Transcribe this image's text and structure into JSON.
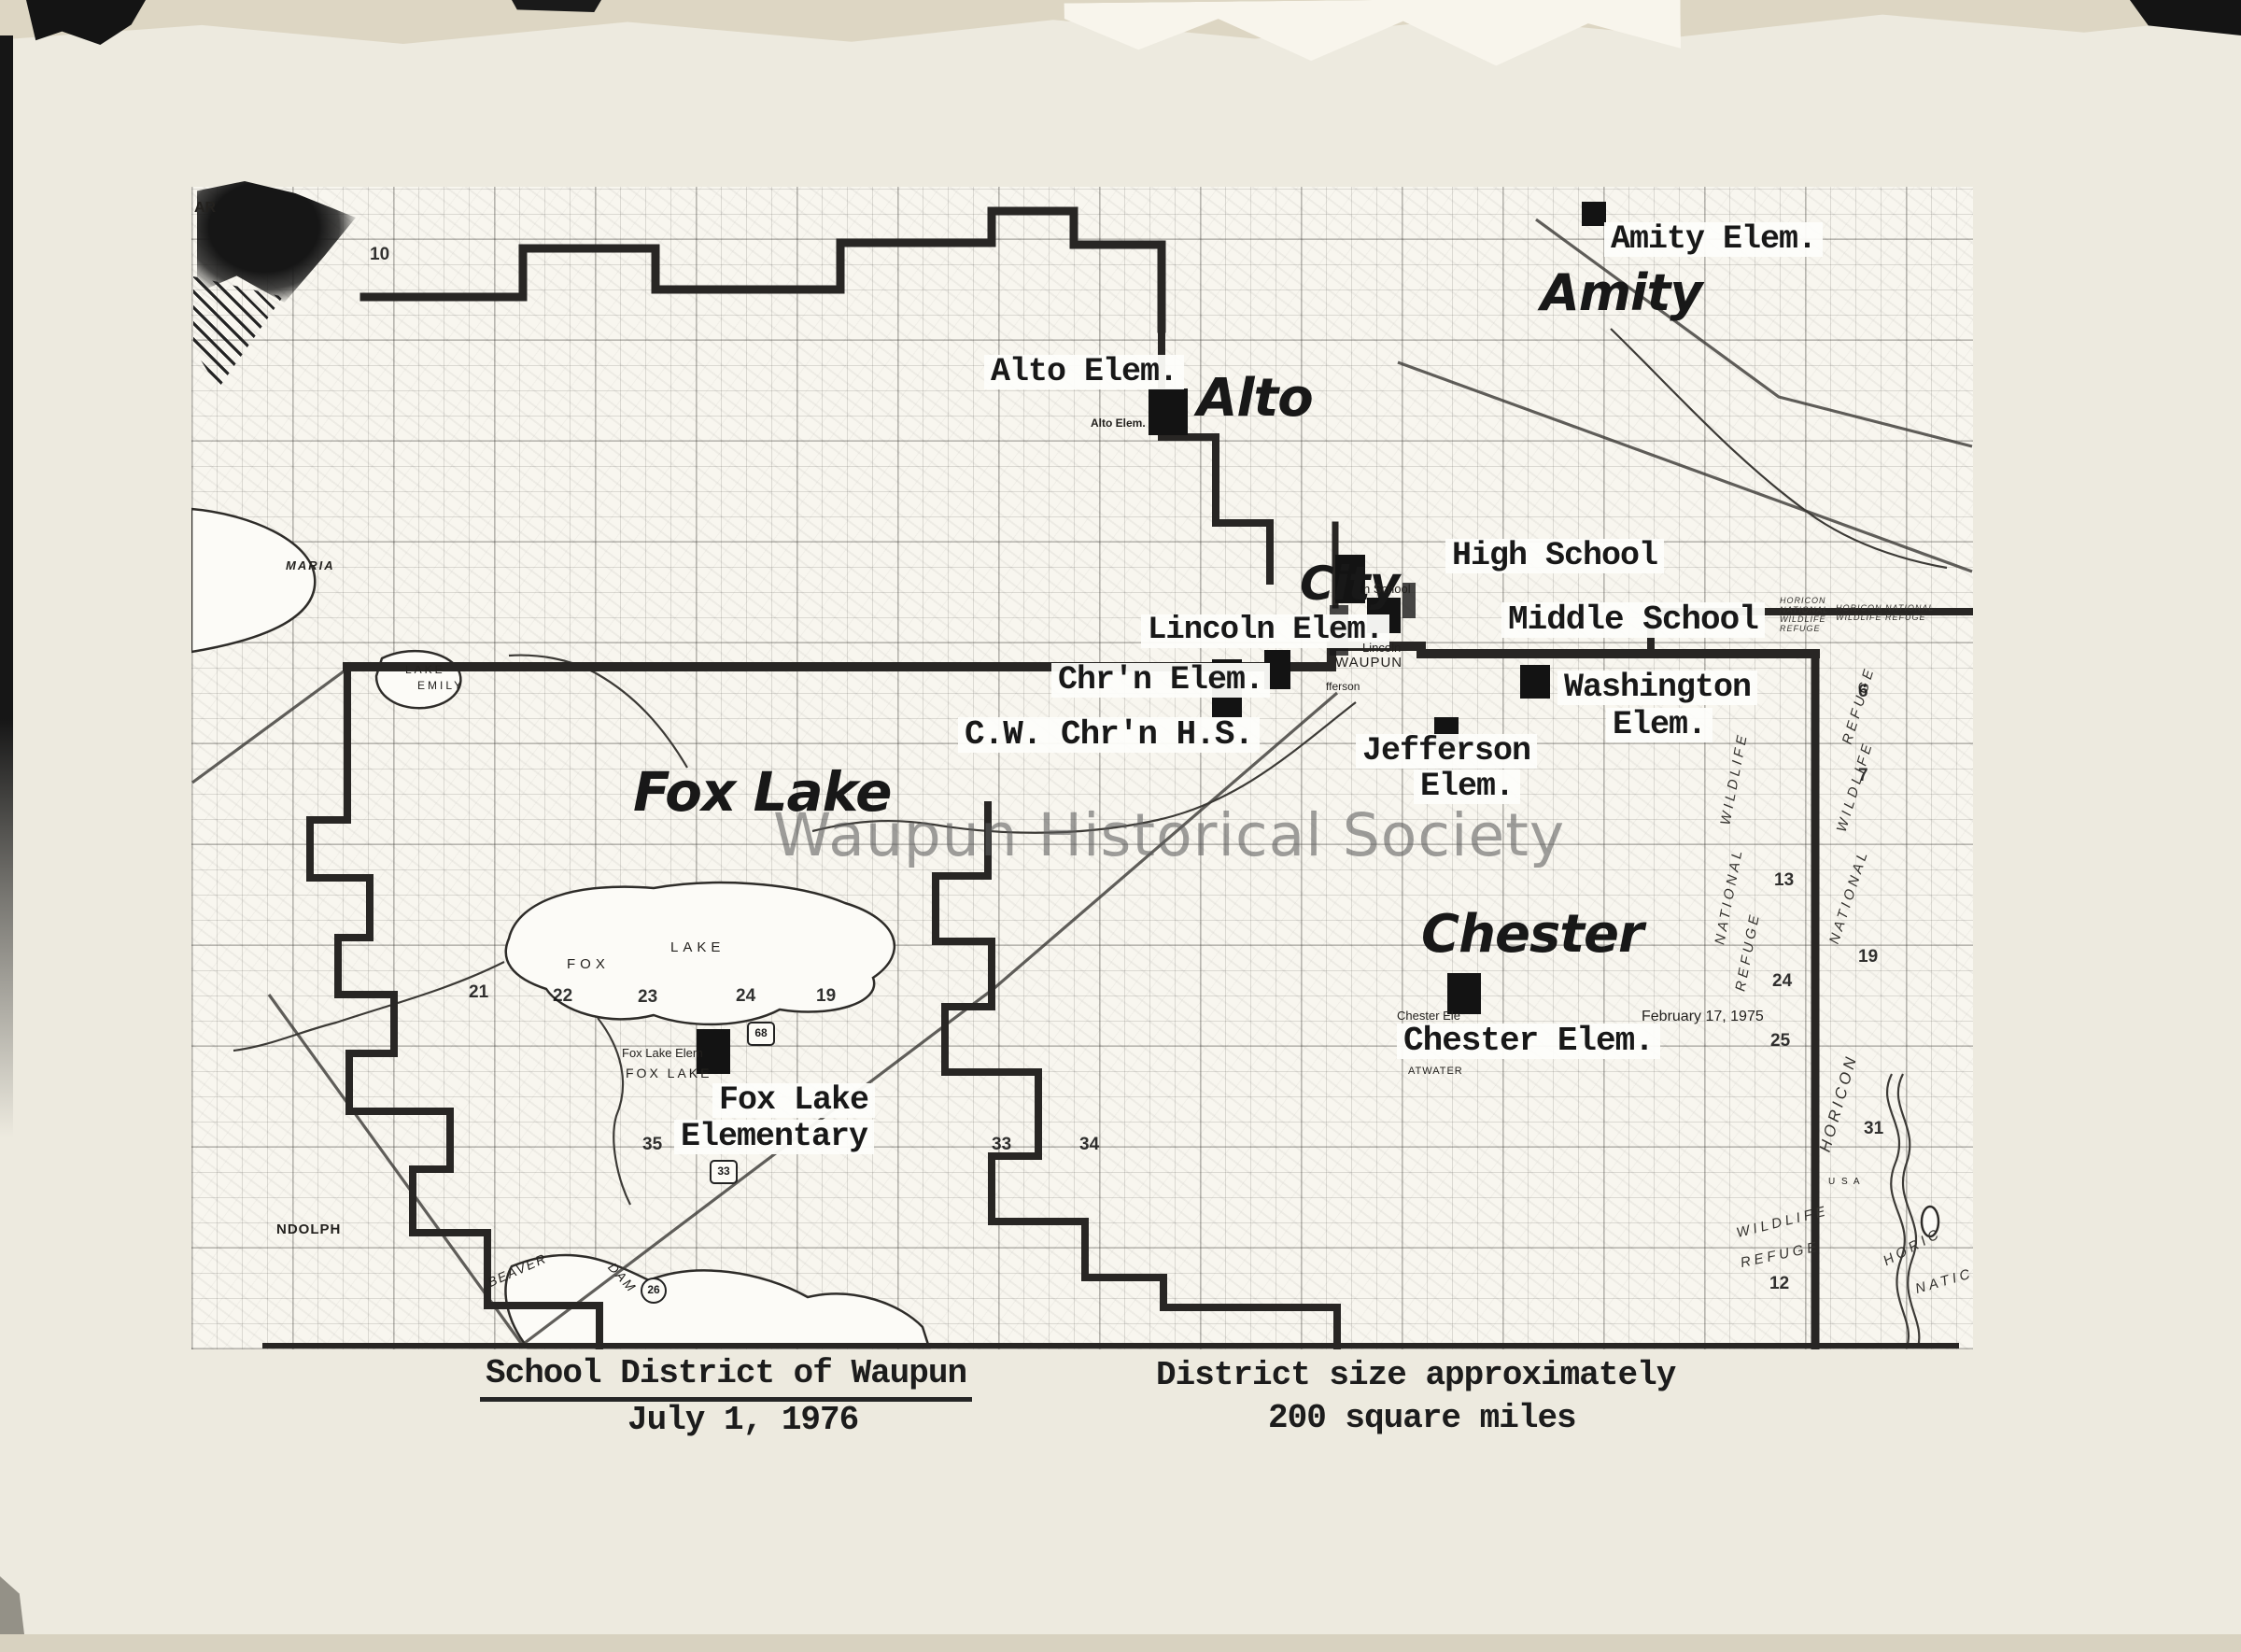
{
  "map": {
    "schools": {
      "amity_elem": "Amity Elem.",
      "alto_elem": "Alto Elem.",
      "high_school": "High School",
      "middle_school": "Middle School",
      "lincoln_elem": "Lincoln Elem.",
      "chrn_elem": "Chr'n Elem.",
      "cw_chrn_hs": "C.W. Chr'n H.S.",
      "washington_line1": "Washington",
      "washington_line2": "Elem.",
      "jefferson_line1": "Jefferson",
      "jefferson_line2": "Elem.",
      "chester_elem": "Chester Elem.",
      "fox_lake_line1": "Fox Lake",
      "fox_lake_line2": "Elementary"
    },
    "towns": {
      "amity": "Amity",
      "alto": "Alto",
      "city": "City",
      "fox_lake": "Fox Lake",
      "chester": "Chester"
    },
    "print": {
      "ar": "AR",
      "maria": "MARIA",
      "lake_emily_1": "LAKE",
      "lake_emily_2": "EMILY",
      "fox": "FOX",
      "lake": "LAKE",
      "alto_small": "Alto Elem.",
      "h_school": "h School",
      "lincoln": "Lincoln",
      "waupun": "WAUPUN",
      "fferson": "fferson",
      "fox_lake_elem_small": "Fox Lake Elem",
      "fox_lake_caps": "FOX LAKE",
      "chester_small": "Chester Ele",
      "atwater": "ATWATER",
      "date_note": "February 17, 1975",
      "ndolph": "NDOLPH",
      "beaver": "BEAVER",
      "dam": "DAM",
      "usa": "U S A"
    },
    "refuge": {
      "block1_l1": "HORICON",
      "block1_l2": "NATIONAL",
      "block1_l3": "WILDLIFE",
      "block1_l4": "REFUGE",
      "block2_l1": "HORICON NATIONAL",
      "block2_l2": "WILDLIFE  REFUGE",
      "w1": "WILDLIFE",
      "n1": "NATIONAL",
      "r1": "REFUGE",
      "r2": "REFUGE",
      "w2": "WILDLIFE",
      "n2": "NATIONAL",
      "horicon_v": "HORICON",
      "w3": "WILDLIFE",
      "r3": "REFUGE",
      "horic": "HORIC",
      "natic": "NATIC"
    },
    "sections": {
      "s10": "10",
      "s21": "21",
      "s22": "22",
      "s23": "23",
      "s24": "24",
      "s19": "19",
      "s35": "35",
      "s33": "33",
      "s34": "34",
      "s13": "13",
      "s24b": "24",
      "s25": "25",
      "s6": "6",
      "s7": "7",
      "s19b": "19",
      "s31": "31",
      "s12": "12"
    },
    "shields": {
      "h68": "68",
      "h33": "33",
      "c26": "26"
    },
    "watermark": "Waupun Historical Society"
  },
  "caption": {
    "title": "School District of Waupun",
    "date": "July 1, 1976",
    "size_line1": "District size approximately",
    "size_line2": "200 square miles"
  }
}
